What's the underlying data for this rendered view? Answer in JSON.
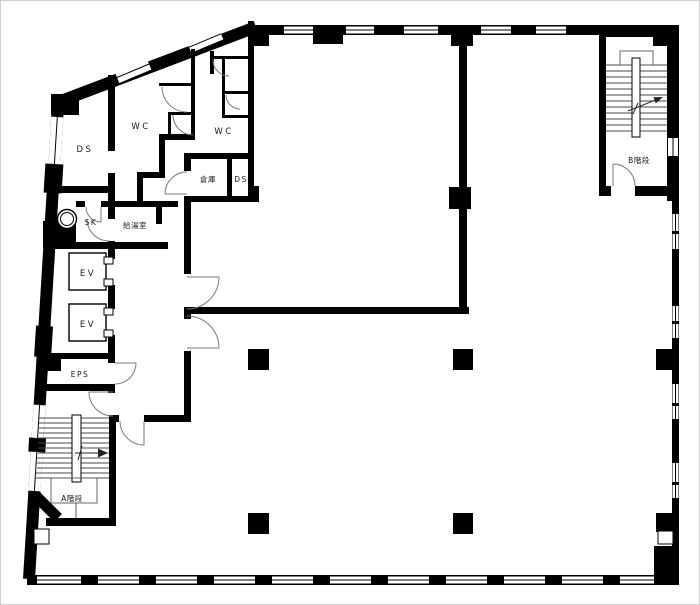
{
  "plan": {
    "type": "architectural-floor-plan",
    "colors": {
      "walls": "#000000",
      "background": "#ffffff",
      "thin_lines": "#4a4a4a",
      "door_arcs": "#7a7a7a"
    },
    "rooms": [
      {
        "id": "ds-main",
        "label": "DS"
      },
      {
        "id": "wc-west",
        "label": "WC"
      },
      {
        "id": "wc-east",
        "label": "WC"
      },
      {
        "id": "souko",
        "label": "倉庫"
      },
      {
        "id": "ds-small",
        "label": "DS"
      },
      {
        "id": "sk",
        "label": "SK"
      },
      {
        "id": "kyutou",
        "label": "給湯室"
      },
      {
        "id": "ev-upper",
        "label": "EV"
      },
      {
        "id": "ev-lower",
        "label": "EV"
      },
      {
        "id": "eps",
        "label": "EPS"
      },
      {
        "id": "stair-a",
        "label": "A階段"
      },
      {
        "id": "stair-b",
        "label": "B階段"
      }
    ]
  }
}
